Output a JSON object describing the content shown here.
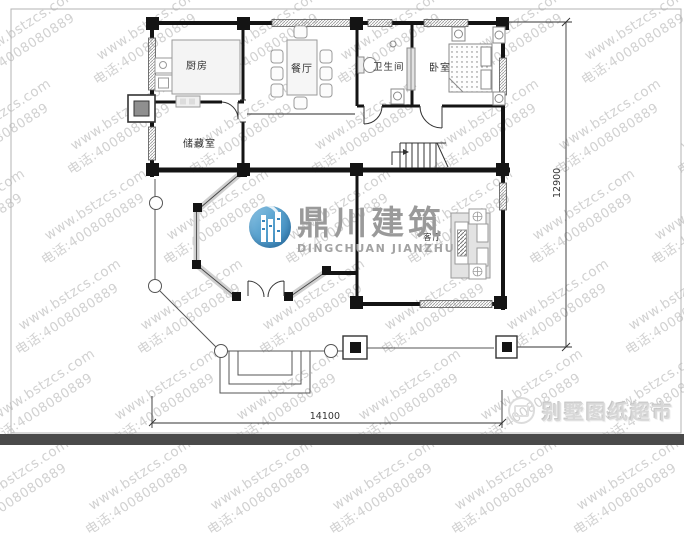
{
  "watermark": {
    "line1": "www.bstzcs.com",
    "line2": "电话:4008080889",
    "color": "#c9c9c9"
  },
  "brand_logo": {
    "title": "鼎川建筑",
    "subtitle": "DINGCHUAN JIANZHU",
    "title_color": "#9a9a9a",
    "icon_color": "#3f8fc4"
  },
  "footer_brand": {
    "label": "别墅图纸超市"
  },
  "plan": {
    "rooms": [
      {
        "id": "kitchen",
        "label": "厨房"
      },
      {
        "id": "dining",
        "label": "餐厅"
      },
      {
        "id": "bathroom",
        "label": "卫生间"
      },
      {
        "id": "bedroom",
        "label": "卧室"
      },
      {
        "id": "storage",
        "label": "储藏室"
      },
      {
        "id": "living",
        "label": "客厅"
      }
    ],
    "dimensions": {
      "bottom": "14100",
      "right": "12900"
    }
  }
}
